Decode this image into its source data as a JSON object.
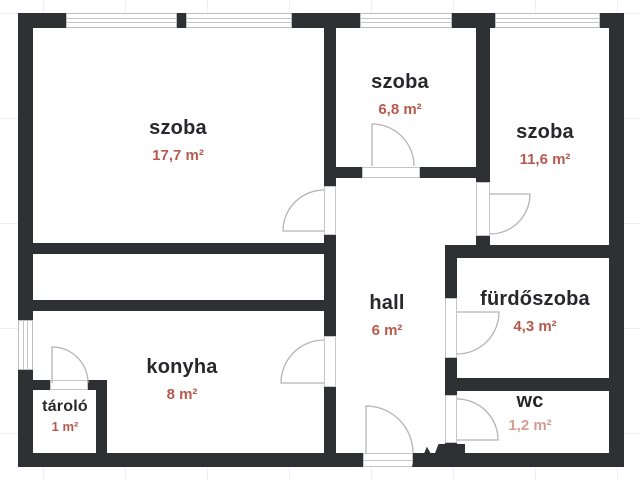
{
  "rooms": [
    {
      "id": "szoba-large",
      "name": "szoba",
      "area": "17,7 m²"
    },
    {
      "id": "szoba-middle",
      "name": "szoba",
      "area": "6,8 m²"
    },
    {
      "id": "szoba-right",
      "name": "szoba",
      "area": "11,6 m²"
    },
    {
      "id": "hall",
      "name": "hall",
      "area": "6 m²"
    },
    {
      "id": "furdoszoba",
      "name": "fürdőszoba",
      "area": "4,3 m²"
    },
    {
      "id": "konyha",
      "name": "konyha",
      "area": "8 m²"
    },
    {
      "id": "tarolo",
      "name": "tároló",
      "area": "1 m²"
    },
    {
      "id": "wc",
      "name": "wc",
      "area": "1,2 m²"
    }
  ],
  "colors": {
    "wall": "#2f3033",
    "room_label": "#28282c",
    "area_label": "#b55a4d",
    "door_line": "#b4b4b4",
    "window_line": "#c6c6c6",
    "grid": "#efeff0"
  }
}
